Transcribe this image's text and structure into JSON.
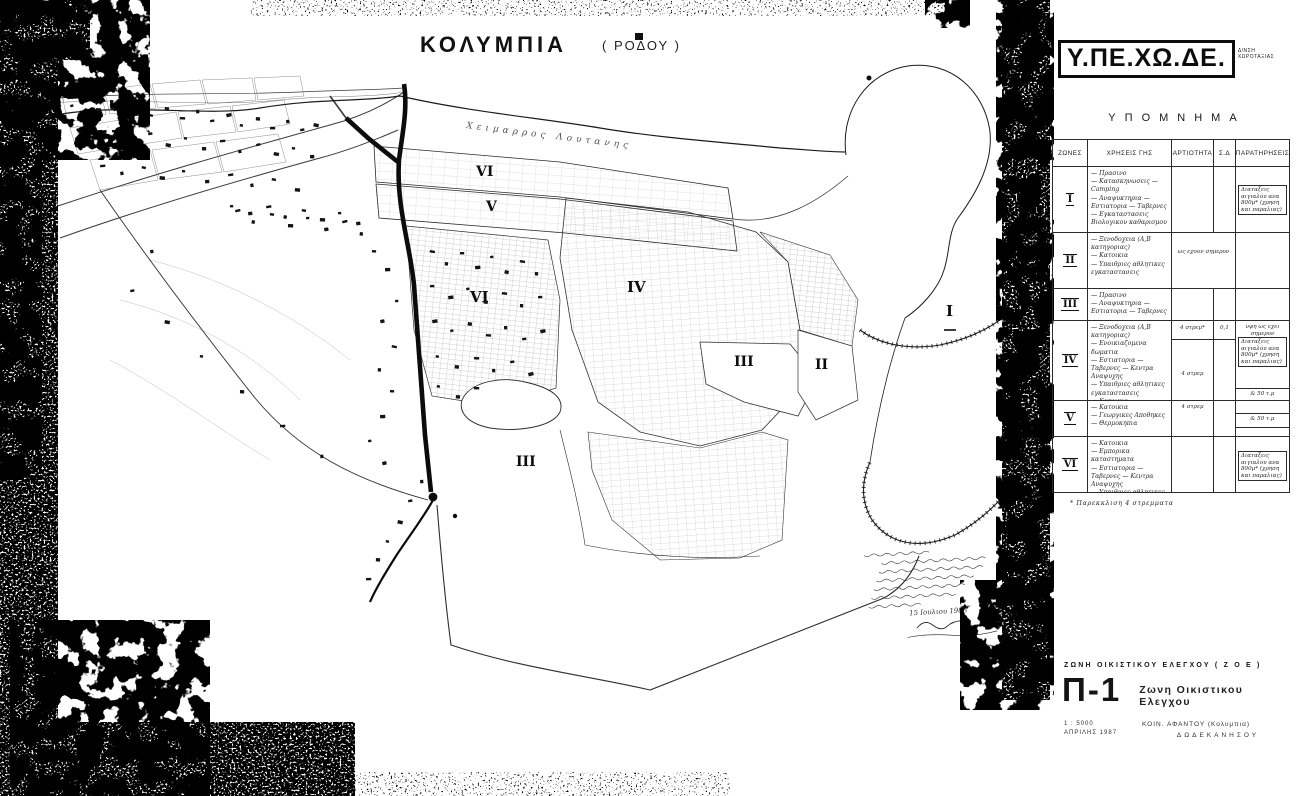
{
  "map": {
    "title_main": "ΚΟΛΥΜΠΙΑ",
    "title_paren": "( ΡΟΔΟΥ )",
    "stream_label": "Χειμαρρος  Λουτανης",
    "zone_labels": [
      "VI",
      "V",
      "VI",
      "IV",
      "III",
      "II",
      "I",
      "III"
    ],
    "note_date": "15 Ιουλιου 1988"
  },
  "header": {
    "agency": "Υ.ΠΕ.ΧΩ.ΔΕ.",
    "dept_line1": "Δ/ΝΣΗ",
    "dept_line2": "ΧΩΡΟΤΑΞΙΑΣ"
  },
  "legend": {
    "heading": "ΥΠΟΜΝΗΜΑ",
    "col_zones": "ΖΩΝΕΣ",
    "col_uses": "ΧΡΗΣΕΙΣ ΓΗΣ",
    "col_artiotita": "ΑΡΤΙΟΤΗΤΑ",
    "col_sd": "Σ.Δ",
    "col_remarks": "ΠΑΡΑΤΗΡΗΣΕΙΣ",
    "footnote": "* Παρεκκλιση 4 στρεμματα",
    "rows": [
      {
        "zone": "I",
        "uses": [
          "Πρασινο",
          "Κατασκηνωσεις — Camping",
          "Αναψυκτηρια — Εστιατορια — Ταβερνες",
          "Εγκαταστασεις Βιολογικου καθαρισμου"
        ],
        "remark_box": "Διαταξεις αιγιαλου ανα 800μ* (χρηση και παραλιας)"
      },
      {
        "zone": "II",
        "uses": [
          "Ξενοδοχεια (Α,Β κατηγοριας)",
          "Κατοικια",
          "Υπαιθριες αθλητικες εγκαταστασεις"
        ],
        "artiotita_note": "ως εχουν σημερον"
      },
      {
        "zone": "III",
        "uses": [
          "Πρασινο",
          "Αναψυκτηρια — Εστιατορια — Ταβερνες"
        ]
      },
      {
        "zone": "IV",
        "uses": [
          "Ξενοδοχεια (Α,Β κατηγοριας)",
          "Ενοικιαζομενα δωματια",
          "Εστιατορια — Ταβερνες — Κεντρα Αναψυχης",
          "Υπαιθριες αθλητικες εγκαταστασεις",
          "Κατοικια",
          "Εμπορικα καταστηματα",
          "Γεωργικες Αποθηκες",
          "Θερμοκηπια"
        ],
        "artiotita_top": "4 στρεμ*",
        "sd_top": "0,1",
        "artiotita_mid": "4 στρεμ",
        "remark_top": "υψη ως εχει σημερον",
        "remark_box": "Διαταξεις αιγιαλου ανα 800μ* (χρηση και παραλιας)",
        "remark_bottom": "& 50 τ.μ"
      },
      {
        "zone": "V",
        "uses": [
          "Κατοικια",
          "Γεωργικες Αποθηκες",
          "Θερμοκηπια"
        ],
        "artiotita_top": "4 στρεμ",
        "remark_bottom": "& 50 τ.μ"
      },
      {
        "zone": "VI",
        "uses": [
          "Κατοικια",
          "Εμπορικα καταστηματα",
          "Εστιατορια — Ταβερνες — Κεντρα Αναψυχης",
          "Υπαιθριες αθλητικες εγκαταστασεις"
        ],
        "remark_box": "Διαταξεις αιγιαλου ανα 800μ* (χρηση και παραλιας)"
      }
    ]
  },
  "titleblock": {
    "zoe_line": "ΖΩΝΗ ΟΙΚΙΣΤΙΚΟΥ ΕΛΕΓΧΟΥ      ( Ζ Ο Ε )",
    "sheet": "Π-1",
    "subtitle": "Ζωνη Οικιστικου Ελεγχου",
    "scale": "1 : 5000",
    "date": "ΑΠΡΙΛΗΣ 1987",
    "municipality": "ΚΟΙΝ. ΑΦΑΝΤΟΥ (Κολυμπια)",
    "prefecture": "ΔΩΔΕΚΑΝΗΣΟΥ"
  }
}
